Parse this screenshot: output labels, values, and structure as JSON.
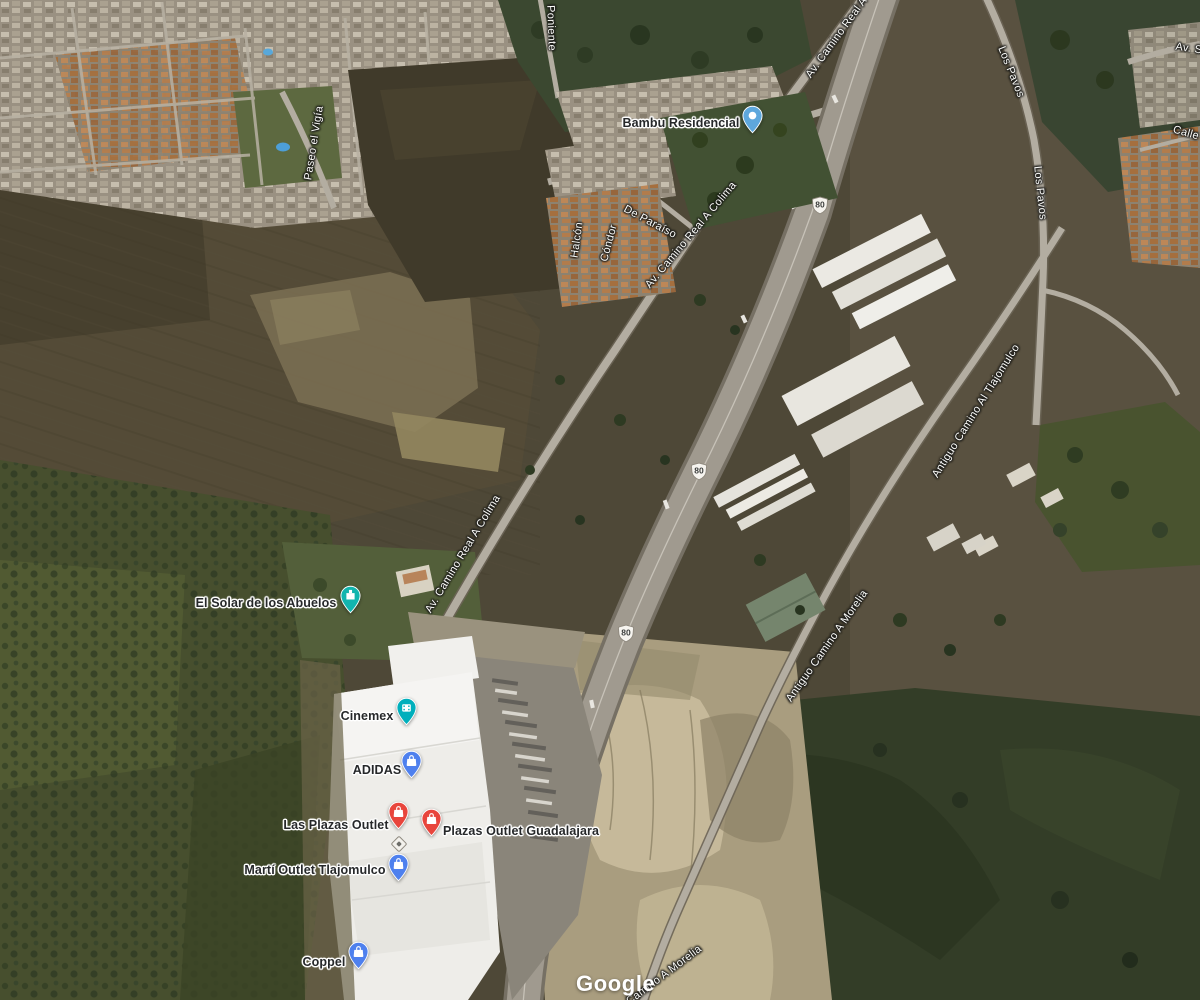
{
  "map": {
    "view": "satellite",
    "attribution": "Google",
    "colors": {
      "poi_label_text": "#26282A",
      "road_label_text": "#FDFDFA",
      "shield_fill": "#F6F4EF",
      "pin_red": "#E8453C",
      "pin_blue": "#4E80EE",
      "pin_teal": "#12B5AE",
      "pin_cyan": "#00AFBC",
      "pin_lightblue": "#5EA7DC"
    },
    "pois": [
      {
        "name": "Bambu Residencial",
        "category": "place",
        "pin_color": "#5EA7DC"
      },
      {
        "name": "El Solar de los Abuelos",
        "category": "lodging",
        "pin_color": "#12B5AE"
      },
      {
        "name": "Cinemex",
        "category": "movies",
        "pin_color": "#00AFBC"
      },
      {
        "name": "ADIDAS",
        "category": "shopping",
        "pin_color": "#4E80EE"
      },
      {
        "name": "Las Plazas Outlet",
        "category": "shopping",
        "pin_color": "#E8453C"
      },
      {
        "name": "Plazas Outlet Guadalajara",
        "category": "shopping",
        "pin_color": "#E8453C"
      },
      {
        "name": "Martí Outlet Tlajomulco",
        "category": "shopping",
        "pin_color": "#4E80EE"
      },
      {
        "name": "Coppel",
        "category": "shopping",
        "pin_color": "#4E80EE"
      }
    ],
    "road_labels": [
      {
        "name": "Poniente"
      },
      {
        "name": "Paseo el Vigía"
      },
      {
        "name": "De Paraíso"
      },
      {
        "name": "Halcón"
      },
      {
        "name": "Cóndor"
      },
      {
        "name": "Av. Camino Real A Colima"
      },
      {
        "name": "Av. Camino Real A Colima"
      },
      {
        "name": "Av. Camino Real A Colima"
      },
      {
        "name": "Los Pavos"
      },
      {
        "name": "Los Pavos"
      },
      {
        "name": "Av. Sa"
      },
      {
        "name": "Calle"
      },
      {
        "name": "Antiguo Camino Al Tlajomulco"
      },
      {
        "name": "Antiguo Camino A Morelia"
      },
      {
        "name": "Antiguo Camino A Morelia"
      }
    ],
    "route_shields": [
      {
        "number": "80"
      },
      {
        "number": "80"
      },
      {
        "number": "80"
      }
    ]
  }
}
